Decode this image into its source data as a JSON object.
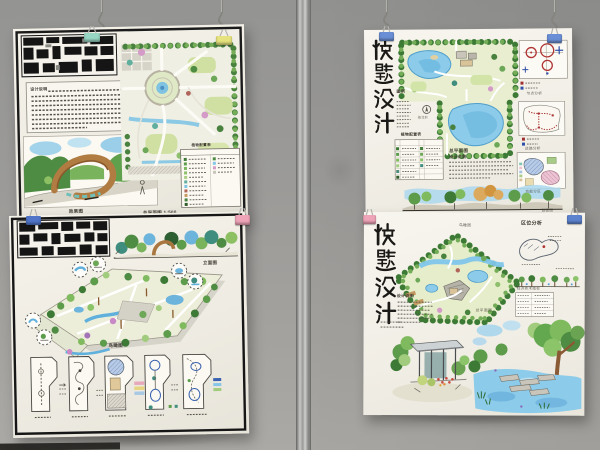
{
  "scene": {
    "description": "Photograph of four hand-drawn landscape architecture exam sheets clipped to a grey exhibition wall",
    "wall_color": "#9b9a98",
    "wall_bottom_color": "#aba9a5",
    "pole_color": "#b7b8b6",
    "floor_strip_color": "#2e2d2a",
    "paper_color": "#f3f0e8"
  },
  "hardware": {
    "hook_color": "#85847f",
    "clips": [
      {
        "name": "mint",
        "color": "#97d6c2"
      },
      {
        "name": "yellow",
        "color": "#e6e37e"
      },
      {
        "name": "blue-left-mid",
        "color": "#4f74c8"
      },
      {
        "name": "pink-left-mid",
        "color": "#efa4b8"
      },
      {
        "name": "blue-top-right-1",
        "color": "#6b8fd6"
      },
      {
        "name": "blue-top-right-2",
        "color": "#6b8fd6"
      },
      {
        "name": "pink-right-mid",
        "color": "#efa4b8"
      },
      {
        "name": "blue-right-mid",
        "color": "#5d83cf"
      }
    ]
  },
  "posters": {
    "top_left": {
      "name": "garden master plan sheet",
      "captions": {
        "notes_title": "设计说明",
        "perspective": "效果图",
        "master_plan": "总平面图 1:500",
        "legend_title": "植物配置表"
      }
    },
    "bottom_left": {
      "name": "axonometric park design sheet",
      "captions": {
        "elevation": "立面图",
        "axonometric": "鸟瞰图"
      }
    },
    "top_right": {
      "title": "快题设计",
      "captions": {
        "legend_title": "图例",
        "north": "指北针",
        "plant_table_title": "植物配置表",
        "master_plan": "总平面图",
        "notes_title": "设计说明",
        "nodes": "节点分析",
        "road": "道路分析",
        "zoning": "功能分区",
        "section": "剖面图"
      }
    },
    "bottom_right": {
      "title": "快题设计",
      "captions": {
        "birdseye": "鸟瞰图",
        "location": "区位分析",
        "master_plan": "总平面图",
        "indicators_title": "经济技术指标",
        "notes_title": "设计说明"
      }
    }
  }
}
